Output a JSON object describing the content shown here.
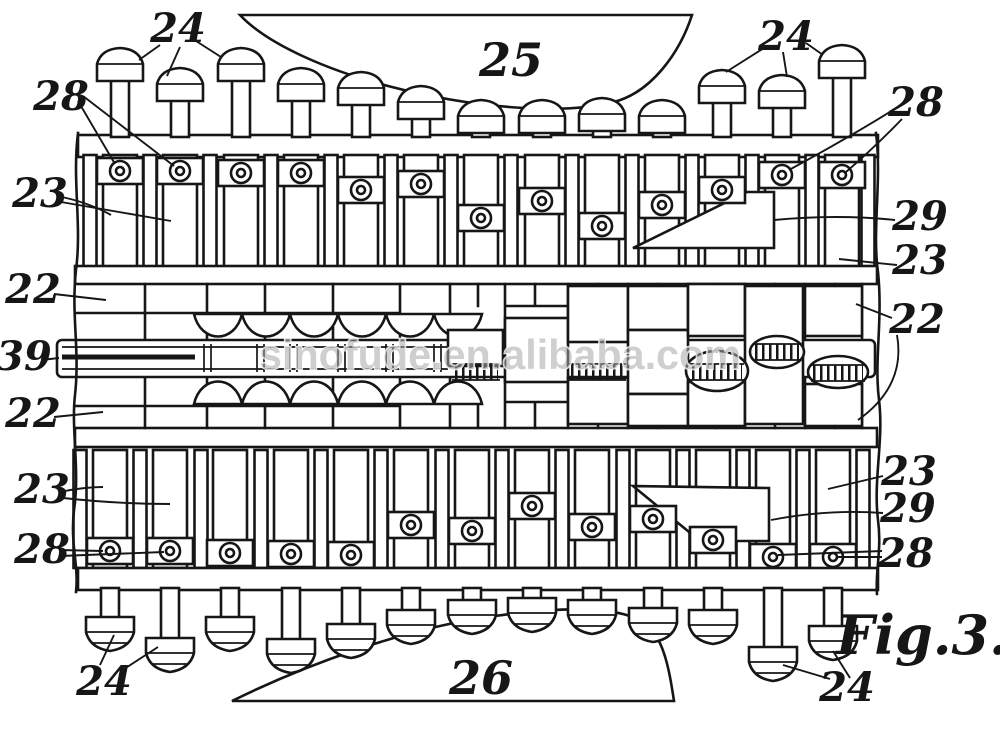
{
  "figure": {
    "caption": "Fig.3.",
    "watermark": "sinofude.en.alibaba.com"
  },
  "reference_labels": {
    "top_left_24": "24",
    "top_right_24": "24",
    "plate_top_25": "25",
    "top_left_28": "28",
    "top_right_28": "28",
    "top_left_23": "23",
    "top_right_29": "29",
    "top_right_23": "23",
    "left_upper_22": "22",
    "right_22": "22",
    "shaft_39": "39",
    "left_lower_22": "22",
    "bottom_left_23": "23",
    "bottom_right_23": "23",
    "bottom_right_29": "29",
    "bottom_left_28": "28",
    "bottom_right_28": "28",
    "bottom_left_24": "24",
    "bottom_right_24": "24",
    "plate_bottom_26": "26"
  }
}
